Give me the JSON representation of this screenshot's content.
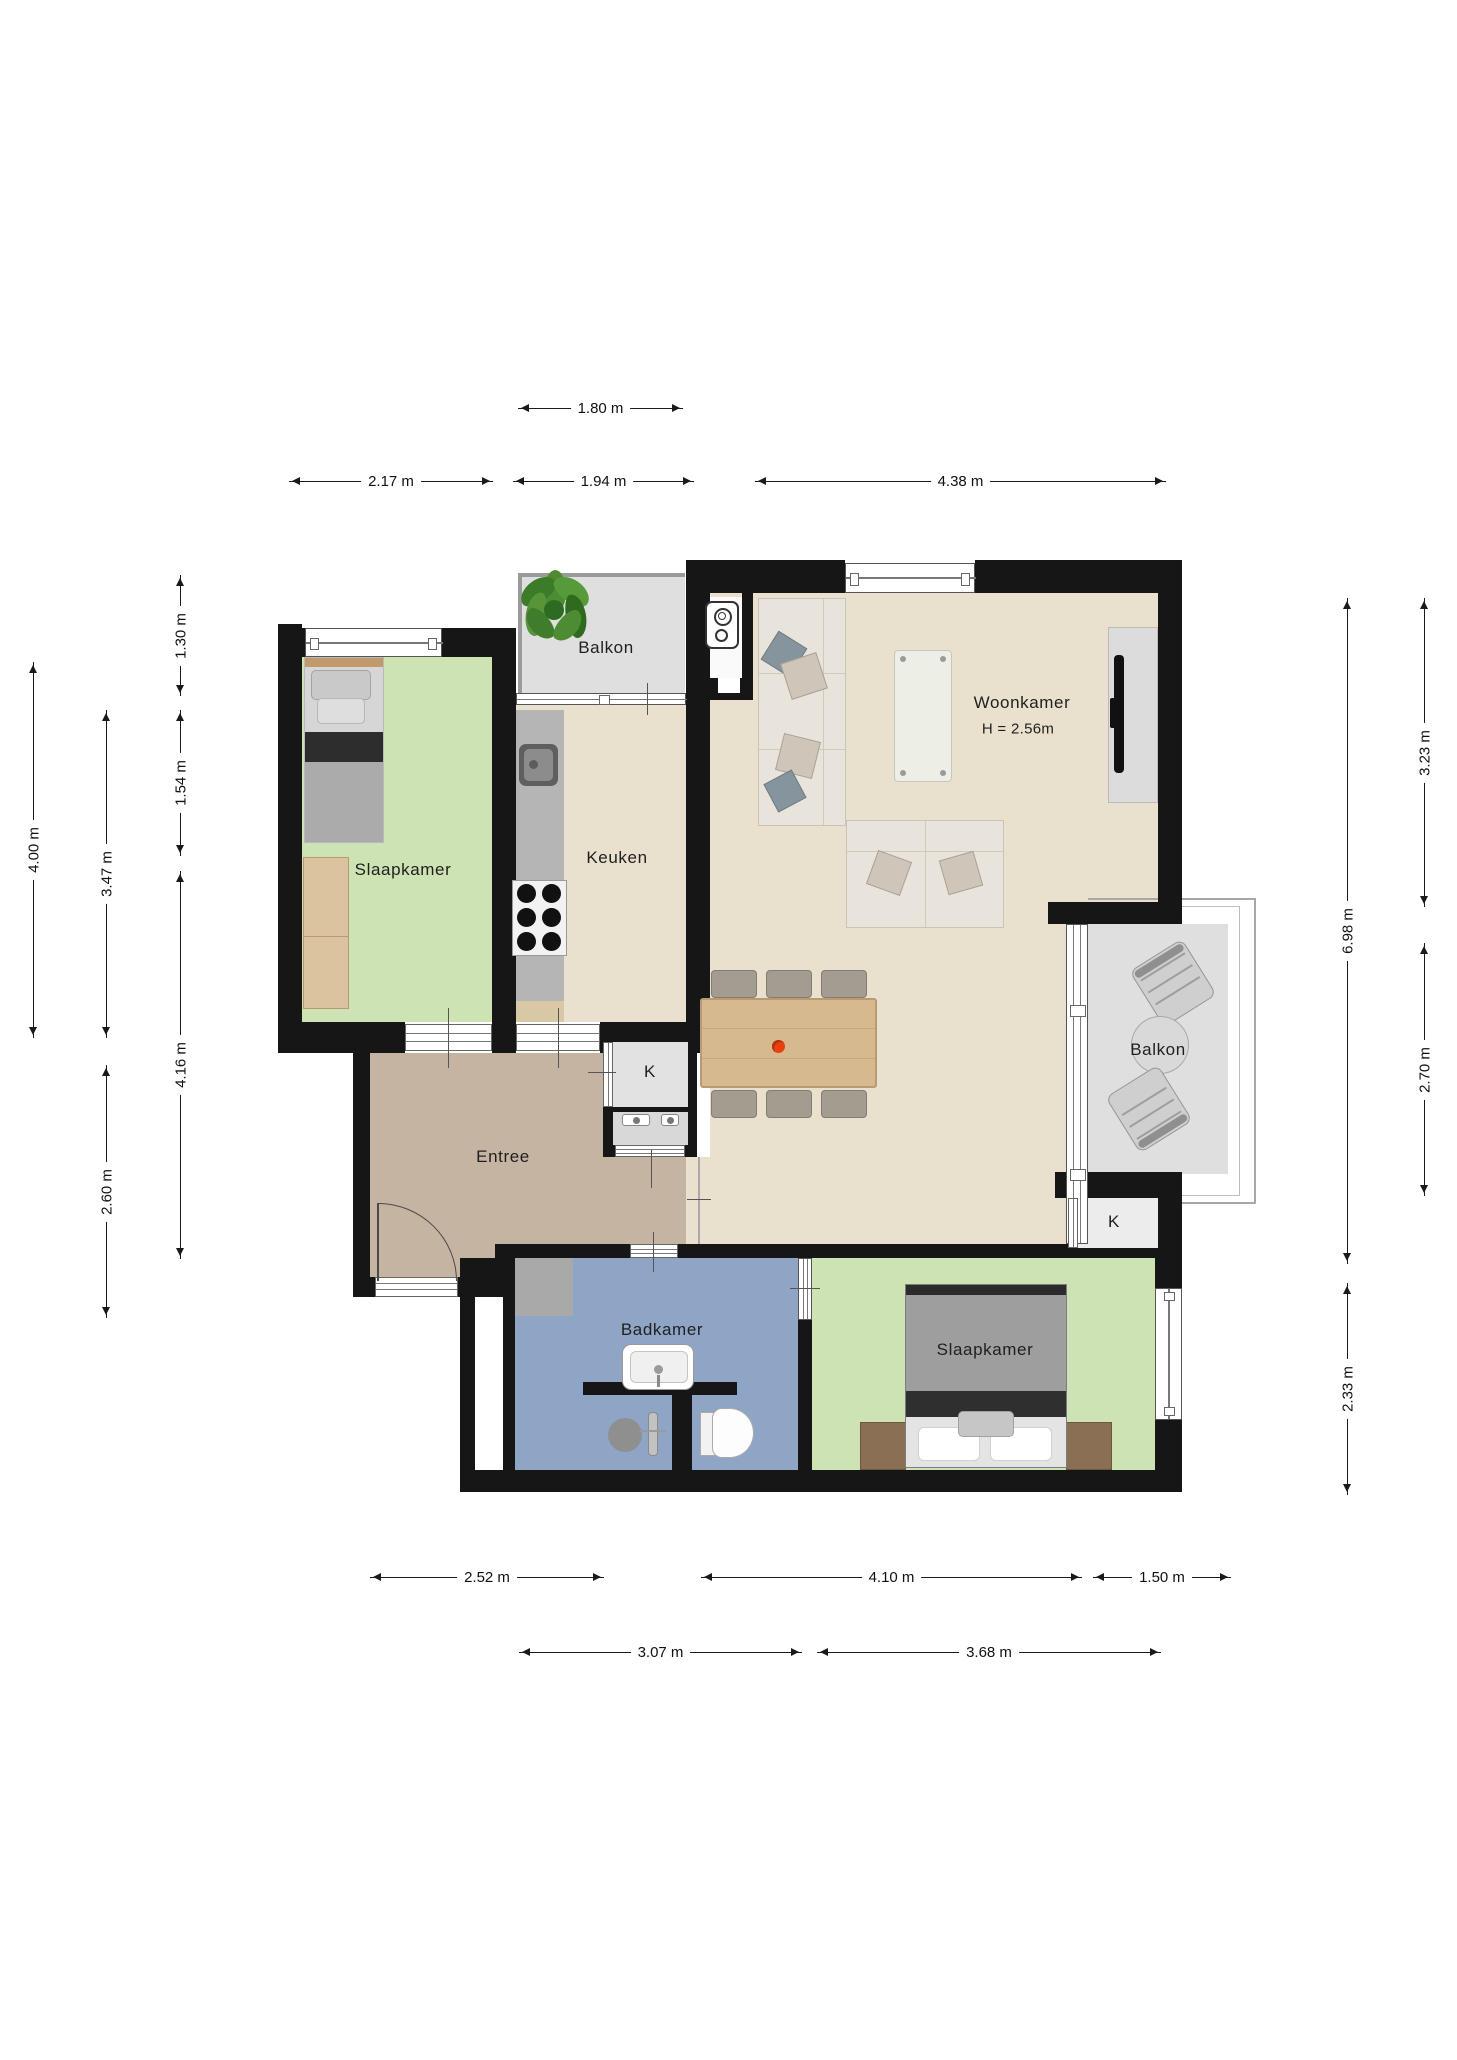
{
  "title": "Apartment floor plan",
  "rooms": {
    "bedroom1": "Slaapkamer",
    "kitchen": "Keuken",
    "living": "Woonkamer",
    "living_height": "H = 2.56m",
    "balcony_top": "Balkon",
    "balcony_right": "Balkon",
    "entry": "Entree",
    "bathroom": "Badkamer",
    "bedroom2": "Slaapkamer",
    "closet_left": "K",
    "closet_right": "K"
  },
  "dimensions": {
    "top": [
      "1.80 m",
      "2.17 m",
      "1.94 m",
      "4.38 m"
    ],
    "left": [
      "1.30 m",
      "1.54 m",
      "4.16 m",
      "3.47 m",
      "2.60 m",
      "4.00 m"
    ],
    "right": [
      "3.23 m",
      "2.70 m",
      "6.98 m",
      "2.33 m"
    ],
    "bottom": [
      "2.52 m",
      "4.10 m",
      "1.50 m",
      "3.07 m",
      "3.68 m"
    ]
  },
  "colors": {
    "wall": "#161616",
    "bedroom_floor": "#cde3b4",
    "living_floor": "#e9e1cd",
    "entry_floor": "#c6b4a3",
    "bathroom_floor": "#8fa5c6",
    "balcony_floor": "#dfdfdf",
    "counter": "#b5b5b5",
    "accent_flower": "#e8410e"
  }
}
